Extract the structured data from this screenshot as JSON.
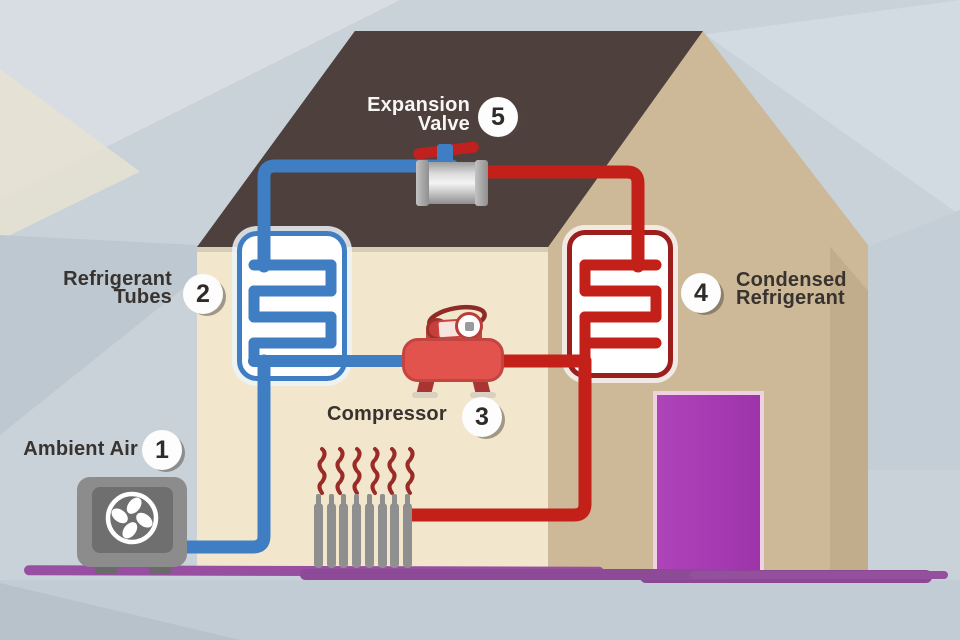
{
  "diagram": {
    "labels": {
      "ambient_air": {
        "number": "1",
        "text": "Ambient Air"
      },
      "refrigerant_tubes": {
        "number": "2",
        "line1": "Refrigerant",
        "line2": "Tubes"
      },
      "compressor": {
        "number": "3",
        "text": "Compressor"
      },
      "condensed_refrigerant": {
        "number": "4",
        "line1": "Condensed",
        "line2": "Refrigerant"
      },
      "expansion_valve": {
        "number": "5",
        "line1": "Expansion",
        "line2": "Valve"
      }
    },
    "colors": {
      "cold_pipe": "#3f7ec3",
      "hot_pipe": "#c32019",
      "roof": "#4e403d",
      "front_wall": "#f2e6cc",
      "side_wall": "#cdb998",
      "door": "#a63ab3",
      "ground": "#94509d",
      "background": "#c9d2d9"
    }
  }
}
